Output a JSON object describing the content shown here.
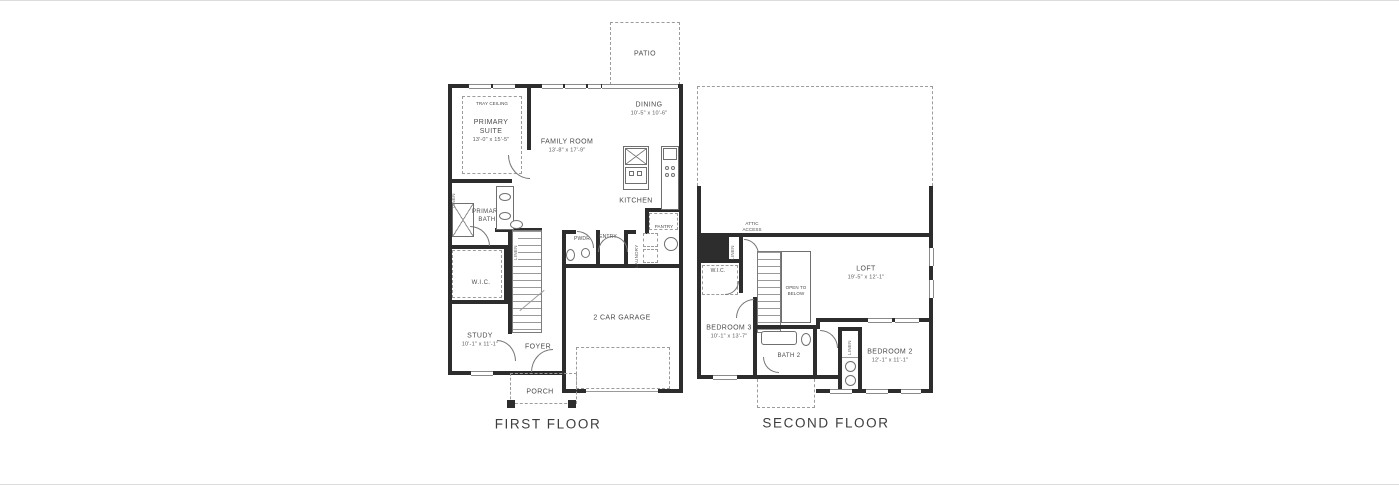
{
  "ff": {
    "caption": "FIRST FLOOR",
    "patio": "PATIO",
    "tray": "TRAY CEILING",
    "primary_suite": "PRIMARY SUITE",
    "primary_suite_dims": "13'-0\" x 15'-5\"",
    "family": "FAMILY ROOM",
    "family_dims": "13'-8\" x 17'-9\"",
    "dining": "DINING",
    "dining_dims": "10'-5\" x 10'-6\"",
    "kitchen": "KITCHEN",
    "pantry": "PANTRY",
    "pwdr": "PWDR",
    "entry": "ENTRY",
    "laundry": "LAUNDRY",
    "primary_bath": "PRIMARY BATH",
    "wic": "W.I.C.",
    "linen": "LINEN",
    "study": "STUDY",
    "study_dims": "10'-1\" x 11'-1\"",
    "foyer": "FOYER",
    "porch": "PORCH",
    "garage": "2 CAR GARAGE"
  },
  "sf": {
    "caption": "SECOND FLOOR",
    "attic": "ATTIC ACCESS",
    "wic": "W.I.C.",
    "linen": "LINEN",
    "loft": "LOFT",
    "loft_dims": "19'-5\" x 12'-1\"",
    "open_below": "OPEN TO BELOW",
    "bedroom3": "BEDROOM 3",
    "bedroom3_dims": "10'-1\" x 13'-7\"",
    "bath2": "BATH 2",
    "bedroom2": "BEDROOM 2",
    "bedroom2_dims": "12'-1\" x 11'-1\""
  },
  "colors": {
    "wall": "#2d2d2d",
    "text": "#4b4b4b",
    "dash": "#9c9c9c",
    "bg": "#ffffff"
  }
}
